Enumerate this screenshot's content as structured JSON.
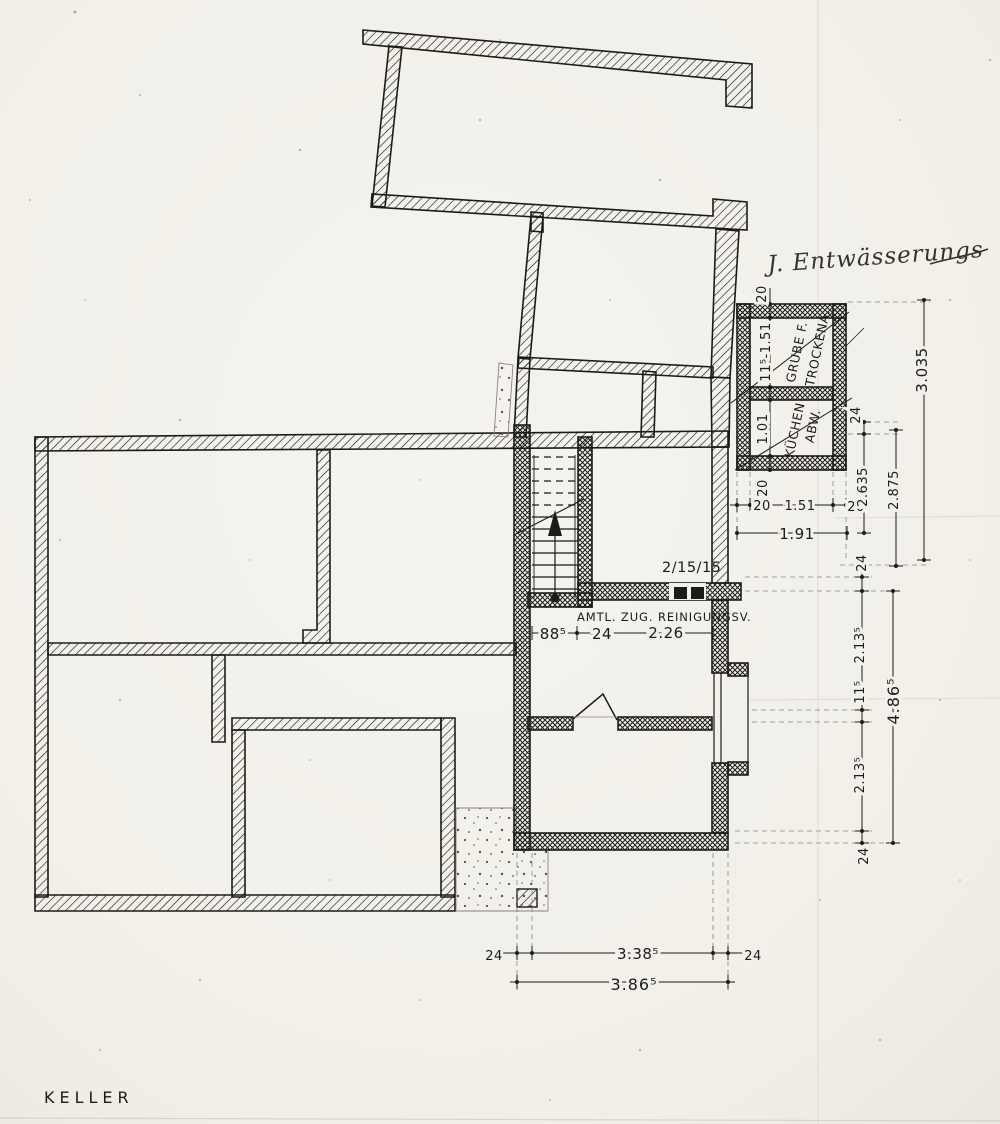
{
  "page": {
    "title": "KELLER"
  },
  "annotations": {
    "handwriting": "J. Entwässerungs",
    "door_spec": "2/15/15",
    "cleanout_note": "AMTL. ZUG. REINIGUNGSV."
  },
  "rooms": {
    "grube_line1": "GRUBE F.",
    "grube_line2": "TROCKENA.",
    "kuechen_line1": "KÜCHEN",
    "kuechen_line2": "ABW."
  },
  "dimensions": {
    "box_vertical": {
      "top_wall": "20",
      "upper_cell": "11⁵-1.51",
      "lower_cell": "1.01",
      "bottom_wall": "20"
    },
    "box_horizontal": {
      "left_wall": "20",
      "inner": "1.51",
      "right_wall": "20",
      "total": "1.91"
    },
    "right_upper": {
      "seg24": "24",
      "d2635": "2.635",
      "d2875": "2.875",
      "d3035": "3.035"
    },
    "corridor": {
      "a": "88⁵",
      "b": "24",
      "c": "2.26"
    },
    "right_lower": {
      "a": "24",
      "b": "2.13⁵",
      "c": "11⁵",
      "d": "2.13⁵",
      "e": "24",
      "total": "4.86⁵"
    },
    "bottom": {
      "a": "24",
      "b": "3.38⁵",
      "c": "24",
      "total": "3.86⁵"
    }
  },
  "colors": {
    "ink": "#1c1b18",
    "paper": "#f2f0ea"
  }
}
